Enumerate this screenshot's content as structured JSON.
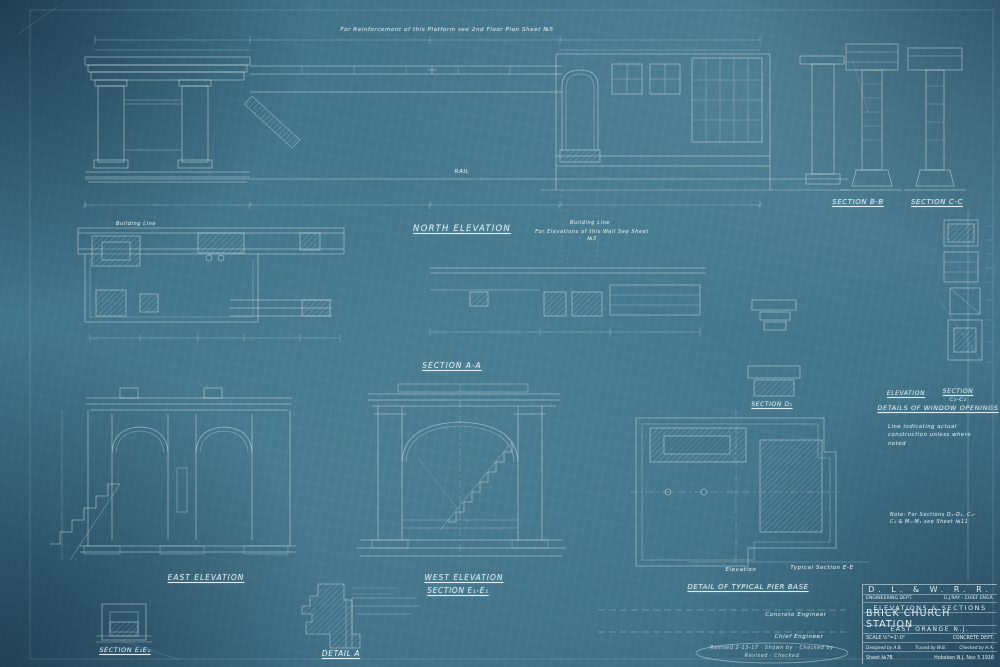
{
  "labels": {
    "top_note": "For Reinforcement of this Platform see 2nd Floor Plan Sheet №5",
    "rail": "RAIL",
    "building_line": "Building Line",
    "wall_note": "For Elevations of this Wall See Sheet №3",
    "north_elevation": "NORTH ELEVATION",
    "section_bb": "SECTION B-B",
    "section_cc": "SECTION C-C",
    "section_aa": "SECTION A-A",
    "section_d2": "SECTION D₂",
    "window_elevation": "ELEVATION",
    "window_section": "SECTION",
    "window_section_sub": "C₂-C₂",
    "details_windows": "DETAILS OF WINDOW OPENINGS",
    "note_construction": "Line indicating actual construction unless where noted",
    "note_sections": "Note: For Sections D₁-D₁, C₂-C₂ & M₁-M₁ see Sheet №11",
    "east_elevation": "EAST ELEVATION",
    "west_elevation": "WEST ELEVATION",
    "section_e1": "SECTION E₁-E₁",
    "section_e2": "SECTION E₂E₂",
    "detail_a": "DETAIL A",
    "elevation_small": "Elevation",
    "typical_section": "Typical Section E-E",
    "detail_pier": "DETAIL OF TYPICAL PIER BASE"
  },
  "signatures": {
    "concrete_engineer": "Concrete Engineer",
    "chief_engineer": "Chief Engineer",
    "stamp_line1": "Revised 2-13-17 · Shown by · Checked by",
    "stamp_line2": "Revised · Checked"
  },
  "title_block": {
    "company": "D. L. & W. R. R.",
    "dept": "ENGINEERING DEPT.",
    "chief": "G.J.RAY - CHIEF ENGR.",
    "subject": "ELEVATIONS & SECTIONS",
    "station": "BRICK CHURCH STATION",
    "location": "EAST ORANGE N.J.",
    "scale": "SCALE ½\"=1'-0\"",
    "dept2": "CONCRETE DEPT.",
    "designed": "Designed by A.B.",
    "traced": "Traced by W.B.",
    "checked": "Checked by H.A.",
    "sheet_no": "Sheet №7B",
    "office_date": "Hoboken N.J. Nov 5 1916"
  },
  "colors": {
    "paper": "#3f7186",
    "lines": "#d7ebf2",
    "margin": "#1c4260"
  }
}
